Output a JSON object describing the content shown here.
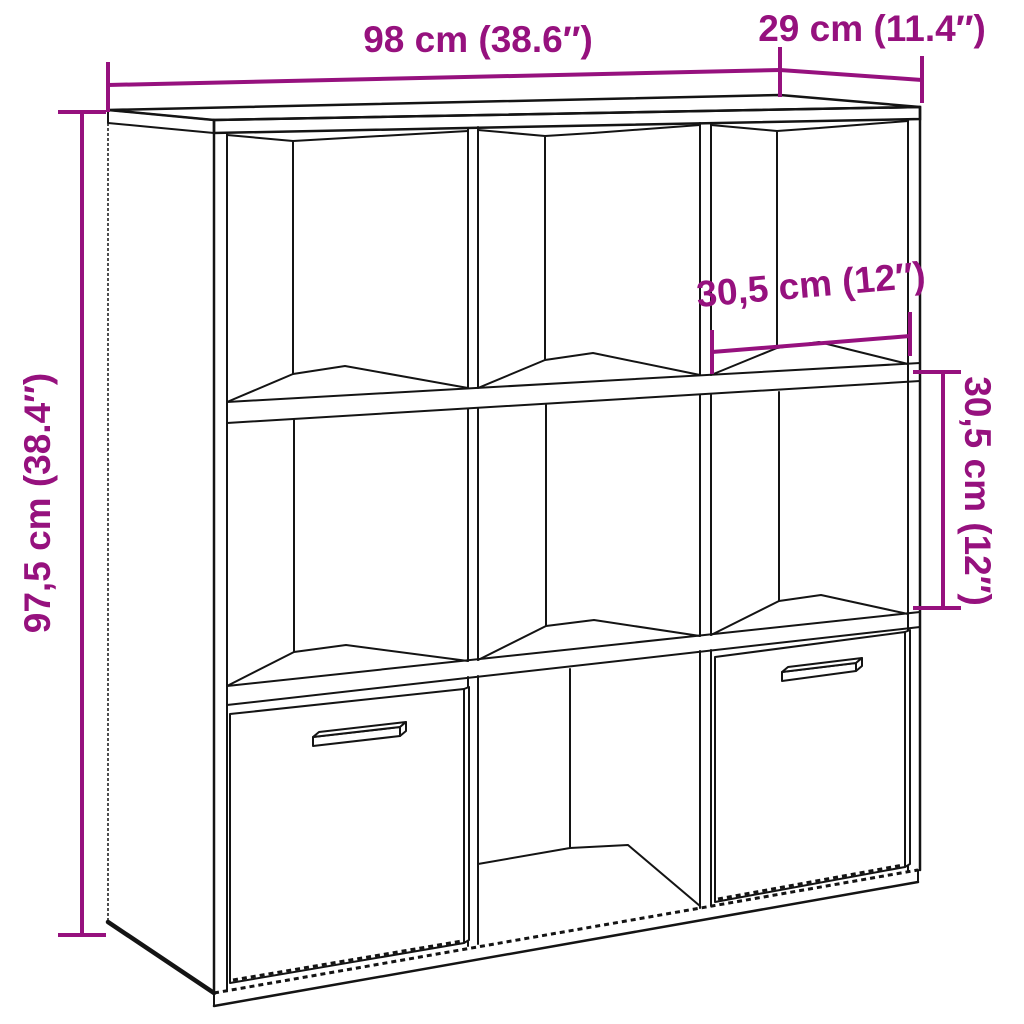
{
  "diagram": {
    "background_color": "#ffffff",
    "line_color": "#141414",
    "accent_color": "#96117E",
    "subject": "3x3 cube storage bookcase with two drawer boxes"
  },
  "dimensions": {
    "width": {
      "label": "98 cm (38.6″)",
      "cm": "98",
      "inches": "38.6"
    },
    "depth": {
      "label": "29 cm (11.4″)",
      "cm": "29",
      "inches": "11.4"
    },
    "height": {
      "label": "97,5 cm (38.4″)",
      "cm": "97,5",
      "inches": "38.4"
    },
    "compartment_width": {
      "label": "30,5 cm (12″)",
      "cm": "30,5",
      "inches": "12"
    },
    "compartment_height": {
      "label": "30,5 cm (12″)",
      "cm": "30,5",
      "inches": "12"
    }
  }
}
